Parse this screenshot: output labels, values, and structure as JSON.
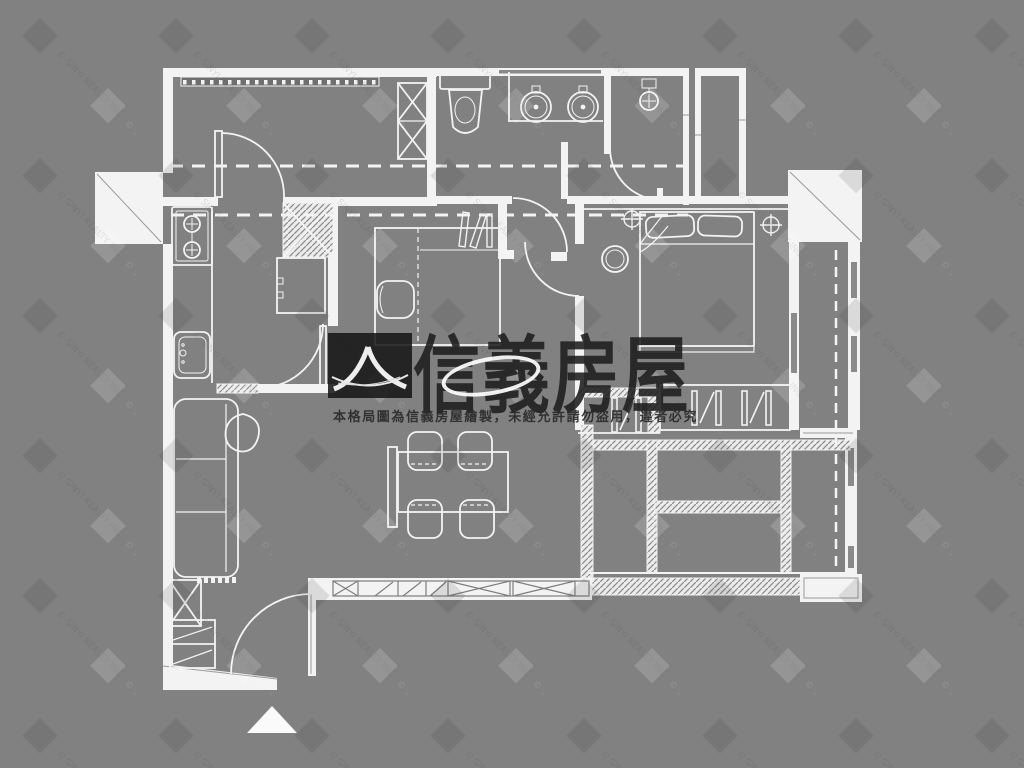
{
  "watermark": {
    "brand": "信義房屋",
    "disclaimer": "本格局圖為信義房屋繪製，未經允許請勿盜用，違者必究",
    "copyright": "© SINYI REALTY INC"
  },
  "colors": {
    "background": "#818181",
    "plan_line": "#f3f3f3",
    "logo_dark": "#161616",
    "disclaimer_text": "#2a2a2a"
  },
  "plan": {
    "type": "residential-floor-plan",
    "entrance_marker": "triangle-up"
  }
}
